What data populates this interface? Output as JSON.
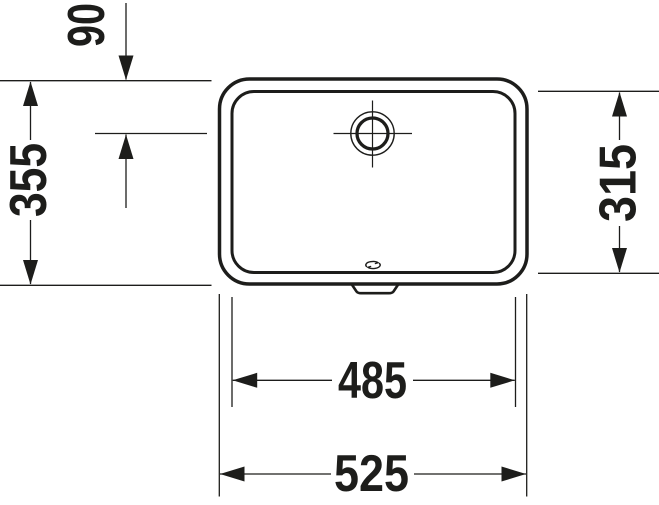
{
  "page": {
    "background": "#ffffff"
  },
  "drawing": {
    "ink_color": "#1d1d1b",
    "view": "top-view-technical-drawing",
    "labels": {
      "drain_offset": "90",
      "outer_depth": "355",
      "inner_depth": "315",
      "inner_width": "485",
      "outer_width": "525"
    },
    "icons": {
      "drain": "drain-crosshair-icon",
      "overflow": "overflow-slot-icon",
      "brand": "brand-squiggle-icon"
    }
  }
}
